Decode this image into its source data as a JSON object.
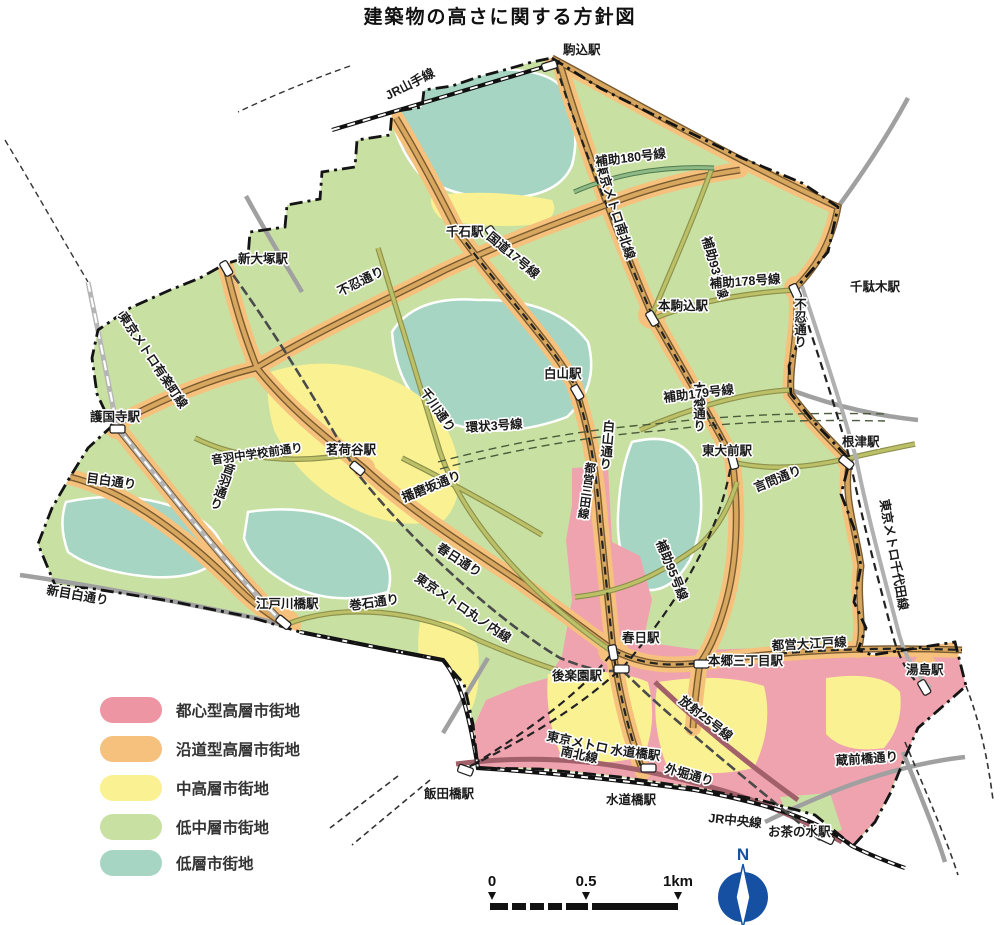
{
  "title": "建築物の高さに関する方針図",
  "legend": {
    "items": [
      {
        "label": "都心型高層市街地",
        "color": "#ed95a3"
      },
      {
        "label": "沿道型高層市街地",
        "color": "#f5c17c"
      },
      {
        "label": "中高層市街地",
        "color": "#faf193"
      },
      {
        "label": "低中層市街地",
        "color": "#c8e0a2"
      },
      {
        "label": "低層市街地",
        "color": "#a6d5c4"
      }
    ]
  },
  "map": {
    "stations": {
      "komagome": "駒込駅",
      "shin_otsuka": "新大塚駅",
      "sengoku": "千石駅",
      "hon_komagome": "本駒込駅",
      "sendagi": "千駄木駅",
      "hakusan": "白山駅",
      "todaimae": "東大前駅",
      "nezu": "根津駅",
      "gokokuji": "護国寺駅",
      "myogadani": "茗荷谷駅",
      "edogawabashi": "江戸川橋駅",
      "kasuga": "春日駅",
      "korakuen": "後楽園駅",
      "hongo_sanchome": "本郷三丁目駅",
      "yushima": "湯島駅",
      "suidobashi_metro": "水道橋駅",
      "suidobashi_jr": "水道橋駅",
      "iidabashi": "飯田橋駅",
      "ochanomizu": "お茶の水駅"
    },
    "roads": {
      "shinobazu_w": "不忍通り",
      "shinobazu_e": "不忍通り",
      "kokudo17": "国道17号線",
      "hakusan_dori": "白山通り",
      "hongo_dori": "本郷通り",
      "kasuga_dori": "春日通り",
      "mejiro": "目白通り",
      "shin_mejiro": "新目白通り",
      "otowa": "音羽通り",
      "otowa_chugakko": "音羽中学校前通り",
      "senkawa": "千川通り",
      "harimazaka": "播磨坂通り",
      "makiishi": "巻石通り",
      "kototoi": "言問通り",
      "sotobori": "外堀通り",
      "kuramaebashi": "蔵前橋通り",
      "hojo180": "補助180号線",
      "hojo93": "補助93号線",
      "hojo178": "補助178号線",
      "hojo179": "補助179号線",
      "hojo95": "補助95号線",
      "kanjo3": "環状3号線",
      "hosha25": "放射25号線"
    },
    "rails": {
      "jr_yamanote": "JR山手線",
      "jr_chuo": "JR中央線",
      "metro_nanboku": "東京メトロ南北線",
      "metro_nanboku_l1": "東京メトロ",
      "metro_nanboku_l2": "南北線",
      "metro_yurakucho": "東京メトロ有楽町線",
      "metro_chiyoda": "東京メトロ千代田線",
      "metro_marunouchi": "東京メトロ丸ノ内線",
      "toei_mita": "都営三田線",
      "toei_oedo": "都営大江戸線"
    },
    "scale": {
      "zero": "0",
      "half": "0.5",
      "one": "1km"
    },
    "compass_n": "N"
  }
}
